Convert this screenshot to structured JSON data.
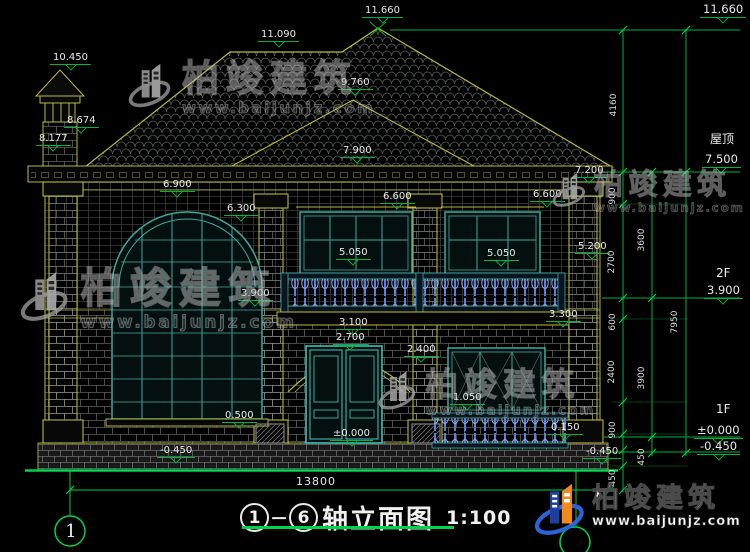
{
  "colors": {
    "dim_green": "#00b43c",
    "bright_green": "#00d448",
    "outline_yellow": "#b9b93f",
    "window_teal": "#3fa89e",
    "door_teal": "#46c8bc",
    "baluster_blue": "#5b7fd4",
    "text_white": "#e9e9e9",
    "logo_blue": "#1d3f9e",
    "logo_orange": "#f28a1d"
  },
  "watermark": {
    "brand": "柏竣建筑",
    "url": "www.baijunjz.com"
  },
  "watermarks": [
    {
      "x": 128,
      "y": 60,
      "s": 1
    },
    {
      "x": 552,
      "y": 170,
      "s": 0.78
    },
    {
      "x": 20,
      "y": 268,
      "s": 1.12
    },
    {
      "x": 378,
      "y": 368,
      "s": 0.88
    }
  ],
  "footer_logo": {
    "brand": "柏竣建筑",
    "url": "www.baijunjz.com"
  },
  "title": {
    "axis_start": "1",
    "axis_end": "6",
    "name": "轴立面图",
    "scale": "1:100"
  },
  "axis_bubble_left": "1",
  "ground_dim": "13800",
  "side_labels": [
    {
      "t": "屋顶",
      "x": 710,
      "y": 130
    },
    {
      "t": "2F",
      "x": 716,
      "y": 266
    },
    {
      "t": "1F",
      "x": 716,
      "y": 402
    }
  ],
  "levels": [
    {
      "t": "10.450",
      "x": 50,
      "y": 53
    },
    {
      "t": "8.674",
      "x": 64,
      "y": 116
    },
    {
      "t": "8.177",
      "x": 36,
      "y": 134
    },
    {
      "t": "11.090",
      "x": 258,
      "y": 30
    },
    {
      "t": "11.660",
      "x": 362,
      "y": 6
    },
    {
      "t": "9.760",
      "x": 338,
      "y": 78
    },
    {
      "t": "7.900",
      "x": 340,
      "y": 146
    },
    {
      "t": "7.200",
      "x": 572,
      "y": 166
    },
    {
      "t": "6.900",
      "x": 160,
      "y": 180
    },
    {
      "t": "6.300",
      "x": 224,
      "y": 204
    },
    {
      "t": "6.600",
      "x": 380,
      "y": 192
    },
    {
      "t": "6.600",
      "x": 530,
      "y": 190
    },
    {
      "t": "5.050",
      "x": 336,
      "y": 248
    },
    {
      "t": "5.050",
      "x": 484,
      "y": 249
    },
    {
      "t": "5.200",
      "x": 575,
      "y": 242
    },
    {
      "t": "3.900",
      "x": 238,
      "y": 289
    },
    {
      "t": "3.300",
      "x": 546,
      "y": 310
    },
    {
      "t": "3.100",
      "x": 336,
      "y": 318
    },
    {
      "t": "2.700",
      "x": 333,
      "y": 333
    },
    {
      "t": "2.400",
      "x": 404,
      "y": 345
    },
    {
      "t": "±0.000",
      "x": 330,
      "y": 429
    },
    {
      "t": "1.050",
      "x": 450,
      "y": 393
    },
    {
      "t": "0.150",
      "x": 548,
      "y": 423
    },
    {
      "t": "0.500",
      "x": 222,
      "y": 411
    },
    {
      "t": "-0.450",
      "x": 157,
      "y": 446
    },
    {
      "t": "-0.450",
      "x": 583,
      "y": 447
    },
    {
      "t": "11.660",
      "x": 700,
      "y": 4,
      "b": true
    },
    {
      "t": "7.500",
      "x": 702,
      "y": 154,
      "b": true
    },
    {
      "t": "3.900",
      "x": 704,
      "y": 285,
      "b": true
    },
    {
      "t": "±0.000",
      "x": 694,
      "y": 425,
      "b": true
    },
    {
      "t": "-0.450",
      "x": 697,
      "y": 441,
      "b": true
    }
  ],
  "vdims": [
    {
      "t": "4160",
      "x": 614,
      "y": 105
    },
    {
      "t": "900",
      "x": 613,
      "y": 196
    },
    {
      "t": "2700",
      "x": 612,
      "y": 262
    },
    {
      "t": "3600",
      "x": 642,
      "y": 240
    },
    {
      "t": "600",
      "x": 613,
      "y": 322
    },
    {
      "t": "2400",
      "x": 612,
      "y": 372
    },
    {
      "t": "3900",
      "x": 642,
      "y": 378
    },
    {
      "t": "900",
      "x": 613,
      "y": 430
    },
    {
      "t": "450",
      "x": 642,
      "y": 457
    },
    {
      "t": "450",
      "x": 613,
      "y": 478
    },
    {
      "t": "7950",
      "x": 675,
      "y": 322
    }
  ]
}
